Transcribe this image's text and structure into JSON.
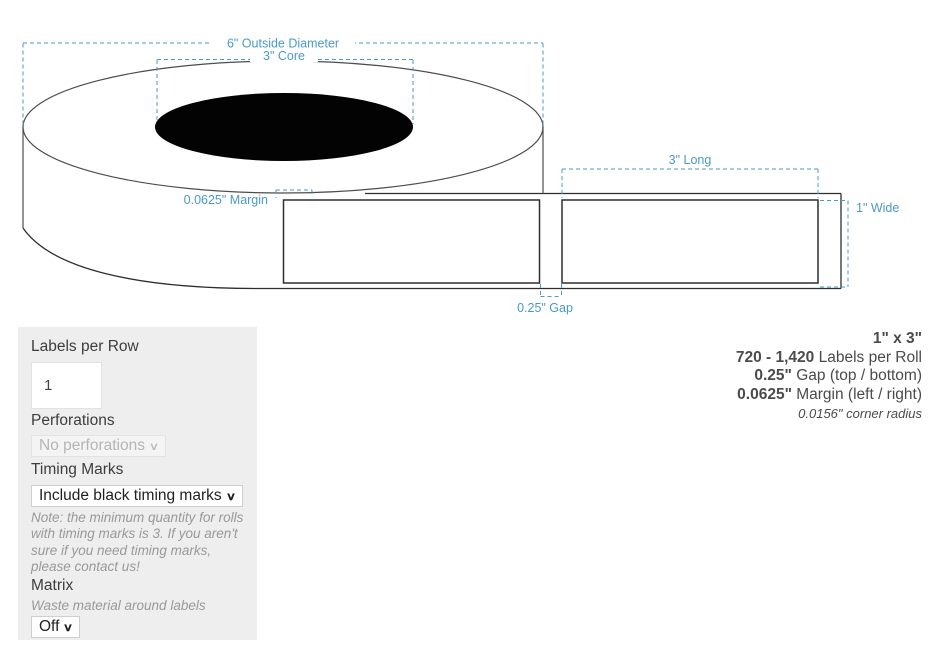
{
  "colors": {
    "annotation_blue": "#4a9ac9",
    "roll_line": "#4d4d4d",
    "label_line": "#2e2e2e",
    "panel_background": "#eeeeee",
    "core_fill": "#030303"
  },
  "diagram": {
    "labels": {
      "outside_diameter": "6\" Outside Diameter",
      "core": "3\" Core",
      "long": "3\" Long",
      "wide": "1\" Wide",
      "margin": "0.0625\" Margin",
      "gap": "0.25\" Gap"
    }
  },
  "specs": {
    "size": {
      "bold": "1\" x 3\"",
      "rest": ""
    },
    "per_roll": {
      "bold": "720 - 1,420",
      "rest": "Labels per Roll"
    },
    "gap": {
      "bold": "0.25\"",
      "rest": "Gap (top / bottom)"
    },
    "margin": {
      "bold": "0.0625\"",
      "rest": "Margin (left / right)"
    },
    "corner_radius": "0.0156\" corner radius"
  },
  "panel": {
    "labels_per_row_label": "Labels per Row",
    "labels_per_row_value": "1",
    "perforations_label": "Perforations",
    "perforations_value": "No perforations",
    "select_chevron": "∨",
    "timing_marks_label": "Timing Marks",
    "timing_marks_value": "Include black timing marks",
    "timing_note": "Note: the minimum quantity for rolls with timing marks is 3. If you aren't sure if you need timing marks, please contact us!",
    "matrix_label": "Matrix",
    "matrix_desc": "Waste material around labels",
    "matrix_value": "Off"
  }
}
